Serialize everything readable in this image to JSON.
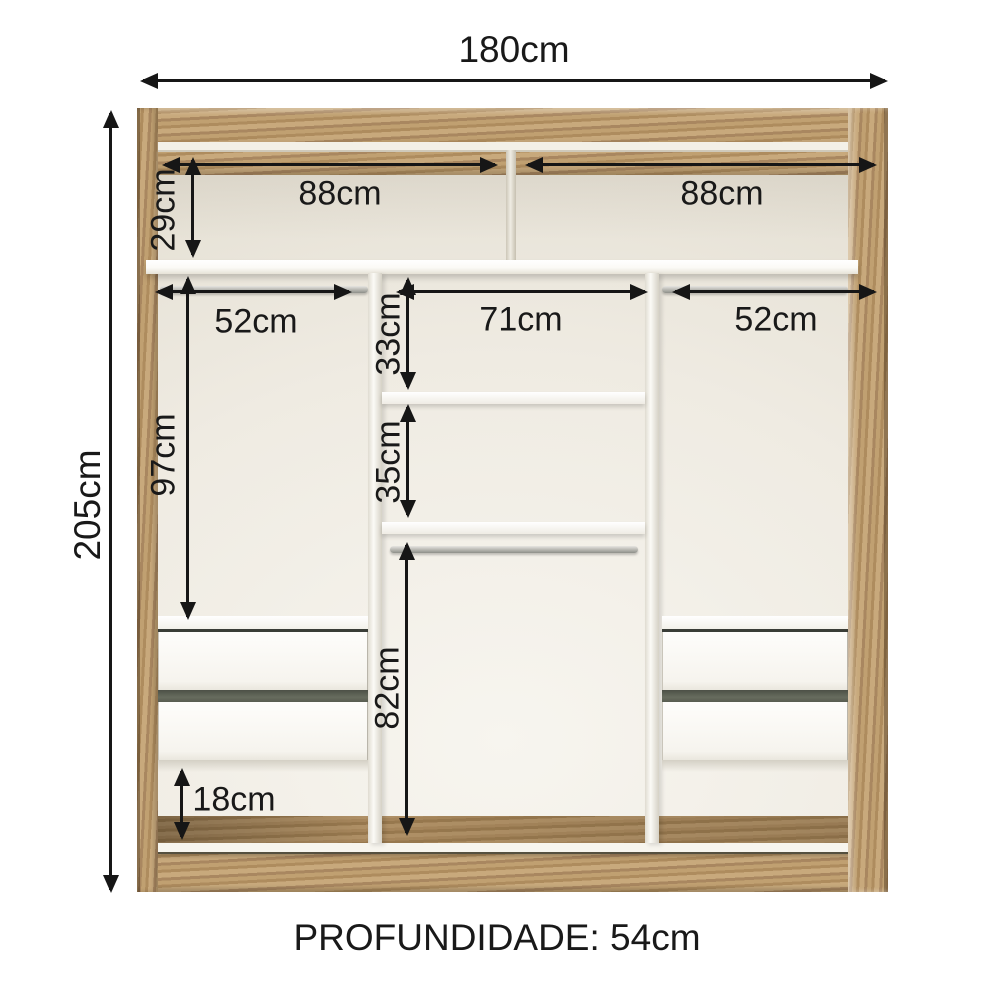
{
  "diagram": {
    "type": "wardrobe-interior-dimension-diagram",
    "depth_label": "PROFUNDIDADE: 54cm",
    "dims": {
      "width": "180cm",
      "height": "205cm",
      "top_left_width": "88cm",
      "top_right_width": "88cm",
      "top_shelf_height": "29cm",
      "left_rod_width": "52cm",
      "center_width": "71cm",
      "right_rod_width": "52cm",
      "center_gap_upper": "33cm",
      "center_gap_lower": "35cm",
      "left_hang_height": "97cm",
      "center_hang_height": "82cm",
      "below_drawer_gap": "18cm"
    },
    "colors": {
      "wood": "#b3925f",
      "wood_light": "#c9ab7e",
      "interior": "#efebe2",
      "panel_white": "#f8f7f2",
      "drawer_gap": "#5b6053",
      "dimension_ink": "#191919",
      "background": "#ffffff"
    }
  }
}
